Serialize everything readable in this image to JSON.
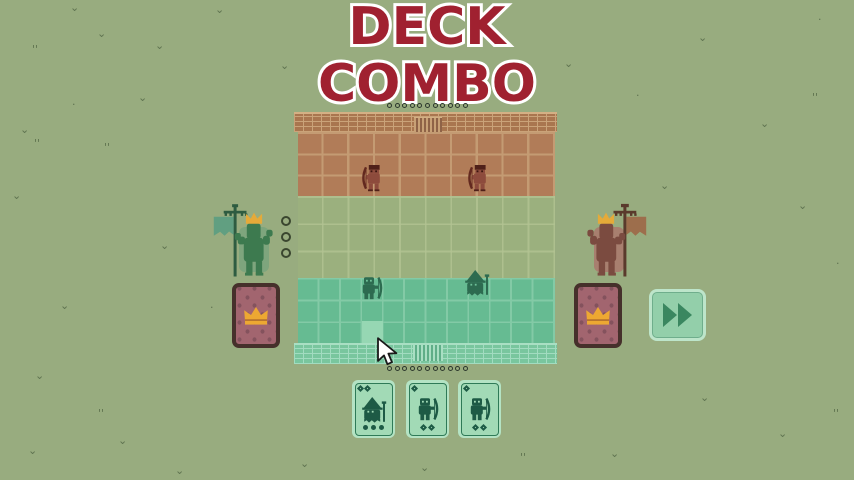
{
  "title": {
    "line1": "DECK",
    "line2": "COMBO"
  },
  "palette": {
    "background": "#98ac7f",
    "title_red": "#a02130",
    "title_outline": "#ffffff",
    "enemy_tile": "#b17c58",
    "neutral_tile": "#9bb07e",
    "player_tile": "#66bb92",
    "card_back": "#a2656f",
    "gold_crown": "#e5aa39",
    "mint_card": "#a2dab6",
    "button_green": "#3a8760"
  },
  "board": {
    "enemy_grid": {
      "rows": 3,
      "cols": 10
    },
    "neutral_grid": {
      "rows": 3,
      "cols": 10
    },
    "player_grid": {
      "rows": 3,
      "cols": 12
    },
    "top_dots": 11,
    "bottom_dots": 11,
    "units": [
      {
        "type": "archer",
        "side": "enemy",
        "x": 360,
        "y": 163
      },
      {
        "type": "archer",
        "side": "enemy",
        "x": 466,
        "y": 163
      },
      {
        "type": "archer",
        "side": "player",
        "x": 360,
        "y": 276
      },
      {
        "type": "wizard",
        "side": "player",
        "x": 464,
        "y": 270
      }
    ],
    "highlight_cell": {
      "x": 362,
      "y": 321,
      "w": 21,
      "h": 22
    }
  },
  "left_player": {
    "figure": "green-king-with-banner",
    "resource_circles": 3,
    "deck": {
      "back_icon": "crown"
    }
  },
  "right_player": {
    "figure": "red-king-with-banner",
    "deck": {
      "back_icon": "crown"
    }
  },
  "controls": {
    "fast_forward": {
      "icon": "fast-forward-icon"
    }
  },
  "hand": {
    "cards": [
      {
        "unit": "wizard",
        "cost": 2,
        "pips": {
          "count": 3,
          "shape": "circle"
        }
      },
      {
        "unit": "archer",
        "cost": 1,
        "pips": {
          "count": 2,
          "shape": "diamond"
        }
      },
      {
        "unit": "archer",
        "cost": 1,
        "pips": {
          "count": 2,
          "shape": "diamond"
        }
      }
    ]
  },
  "cursor": {
    "x": 376,
    "y": 337
  },
  "background": {
    "marks": [
      {
        "x": 70,
        "y": 2,
        "g": "v"
      },
      {
        "x": 215,
        "y": 4,
        "g": "v"
      },
      {
        "x": 97,
        "y": 28,
        "g": "v"
      },
      {
        "x": 32,
        "y": 44,
        "g": "t"
      },
      {
        "x": 155,
        "y": 40,
        "g": "v"
      },
      {
        "x": 280,
        "y": 60,
        "g": "v"
      },
      {
        "x": 138,
        "y": 92,
        "g": "v"
      },
      {
        "x": 72,
        "y": 99,
        "g": "d"
      },
      {
        "x": 20,
        "y": 124,
        "g": "v"
      },
      {
        "x": 34,
        "y": 138,
        "g": "t"
      },
      {
        "x": 104,
        "y": 142,
        "g": "t"
      },
      {
        "x": 12,
        "y": 190,
        "g": "v"
      },
      {
        "x": 160,
        "y": 240,
        "g": "v"
      },
      {
        "x": 60,
        "y": 300,
        "g": "v"
      },
      {
        "x": 210,
        "y": 302,
        "g": "d"
      },
      {
        "x": 35,
        "y": 370,
        "g": "v"
      },
      {
        "x": 98,
        "y": 408,
        "g": "t"
      },
      {
        "x": 28,
        "y": 445,
        "g": "v"
      },
      {
        "x": 118,
        "y": 435,
        "g": "v"
      },
      {
        "x": 175,
        "y": 465,
        "g": "v"
      },
      {
        "x": 300,
        "y": 458,
        "g": "v"
      },
      {
        "x": 420,
        "y": 462,
        "g": "v"
      },
      {
        "x": 520,
        "y": 452,
        "g": "t"
      },
      {
        "x": 610,
        "y": 448,
        "g": "v"
      },
      {
        "x": 700,
        "y": 392,
        "g": "v"
      },
      {
        "x": 778,
        "y": 428,
        "g": "v"
      },
      {
        "x": 833,
        "y": 408,
        "g": "t"
      },
      {
        "x": 660,
        "y": 180,
        "g": "v"
      },
      {
        "x": 698,
        "y": 32,
        "g": "v"
      },
      {
        "x": 818,
        "y": 14,
        "g": "d"
      },
      {
        "x": 760,
        "y": 118,
        "g": "v"
      },
      {
        "x": 812,
        "y": 92,
        "g": "t"
      },
      {
        "x": 798,
        "y": 200,
        "g": "v"
      },
      {
        "x": 836,
        "y": 258,
        "g": "d"
      },
      {
        "x": 564,
        "y": 58,
        "g": "v"
      },
      {
        "x": 636,
        "y": 90,
        "g": "d"
      }
    ]
  }
}
